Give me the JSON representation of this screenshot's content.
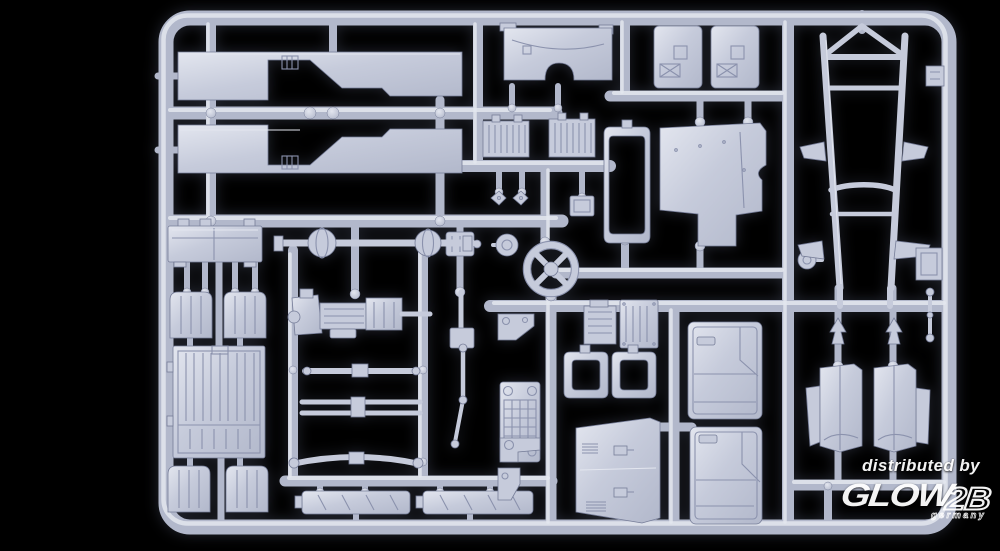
{
  "image": {
    "description": "Product photo of a light grey injection-moulded model kit sprue with truck parts (chassis ladder frame, cab floor panels, doors, seats, cargo bed, axles, engine, steering wheel, fenders) on a black background"
  },
  "colors": {
    "bg": "#000000",
    "plastic": "#c6cbdb",
    "plastic-hi": "#e3e6ef",
    "plastic-mid": "#b2b8cb",
    "plastic-dk": "#8b92ad",
    "edge": "#767d98",
    "watermark": "#ffffff"
  },
  "watermark": {
    "distributed_by": "distributed by",
    "brand_glow": "GLOW",
    "brand_2b": "2B",
    "country": "germany"
  },
  "parts": [
    "cab-floor-panel-upper",
    "cab-floor-panel-lower",
    "dashboard-panel",
    "door-inner-panel-left",
    "door-inner-panel-right",
    "cab-rear-panel",
    "radiator-core-front",
    "radiator-core-rear",
    "windshield-frame",
    "clip-fasteners",
    "relay-box",
    "steering-wheel",
    "horn-dome",
    "transfer-case",
    "front-axle",
    "rear-axle",
    "battery-box",
    "seat-front-left",
    "seat-front-right",
    "seat-rear-left",
    "seat-rear-right",
    "cargo-bed-floor",
    "engine-transmission-assembly",
    "leaf-spring-front",
    "leaf-spring-pair",
    "leaf-spring-rear",
    "running-board-left",
    "running-board-right",
    "steering-column-linkage",
    "mounting-bracket",
    "engine-block-half-left",
    "engine-block-half-right",
    "side-window-frame-left",
    "side-window-frame-right",
    "front-grille",
    "hood-panel",
    "cab-door-front",
    "cab-door-rear",
    "front-fender-left",
    "front-fender-right",
    "fender-clip-left",
    "fender-clip-right",
    "brake-drum",
    "chassis-ladder-frame",
    "axle-link",
    "tail-bracket",
    "number-plate-bracket"
  ]
}
